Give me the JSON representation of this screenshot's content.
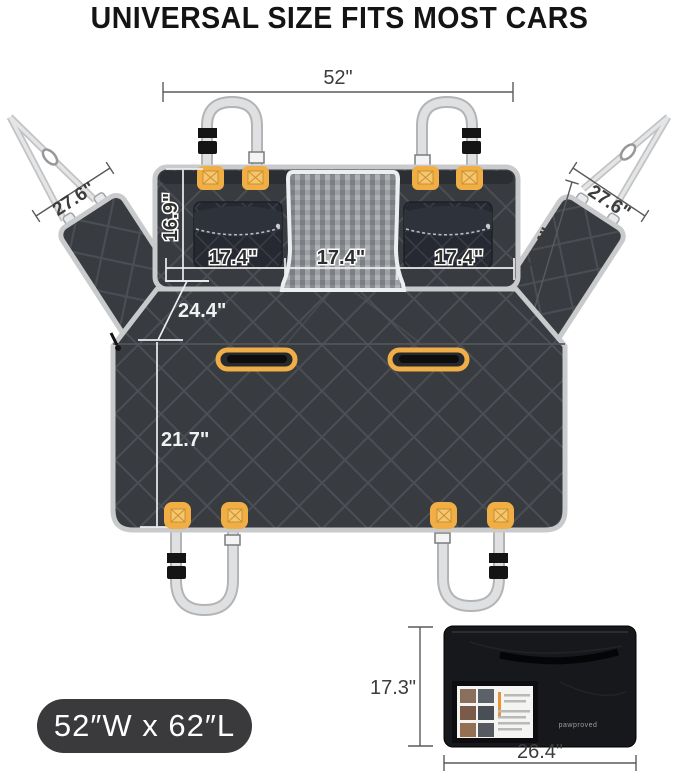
{
  "title": "UNIVERSAL SIZE FITS MOST CARS",
  "size_badge": {
    "label": "52″W x 62″L"
  },
  "measurements": {
    "top_width": "52\"",
    "left_flap_width": "27.6\"",
    "right_flap_width": "27.6\"",
    "right_flap_length": "15.4\"",
    "backrest_height": "16.9\"",
    "pocket_left_width": "17.4\"",
    "mesh_width": "17.4\"",
    "pocket_right_width": "17.4\"",
    "bench_upper_depth": "24.4\"",
    "bench_depth": "21.7\"",
    "bag_height": "17.3\"",
    "bag_width": "26.4\""
  },
  "packed_bag": {
    "brand": "pawproved"
  },
  "colors": {
    "fabric": "#383b40",
    "quilt_seam": "#4b4e54",
    "accent_orange": "#f0ae45",
    "strap_gray": "#dfe0e1",
    "badge_bg": "#3a3a3c",
    "bag_black": "#17181b"
  }
}
